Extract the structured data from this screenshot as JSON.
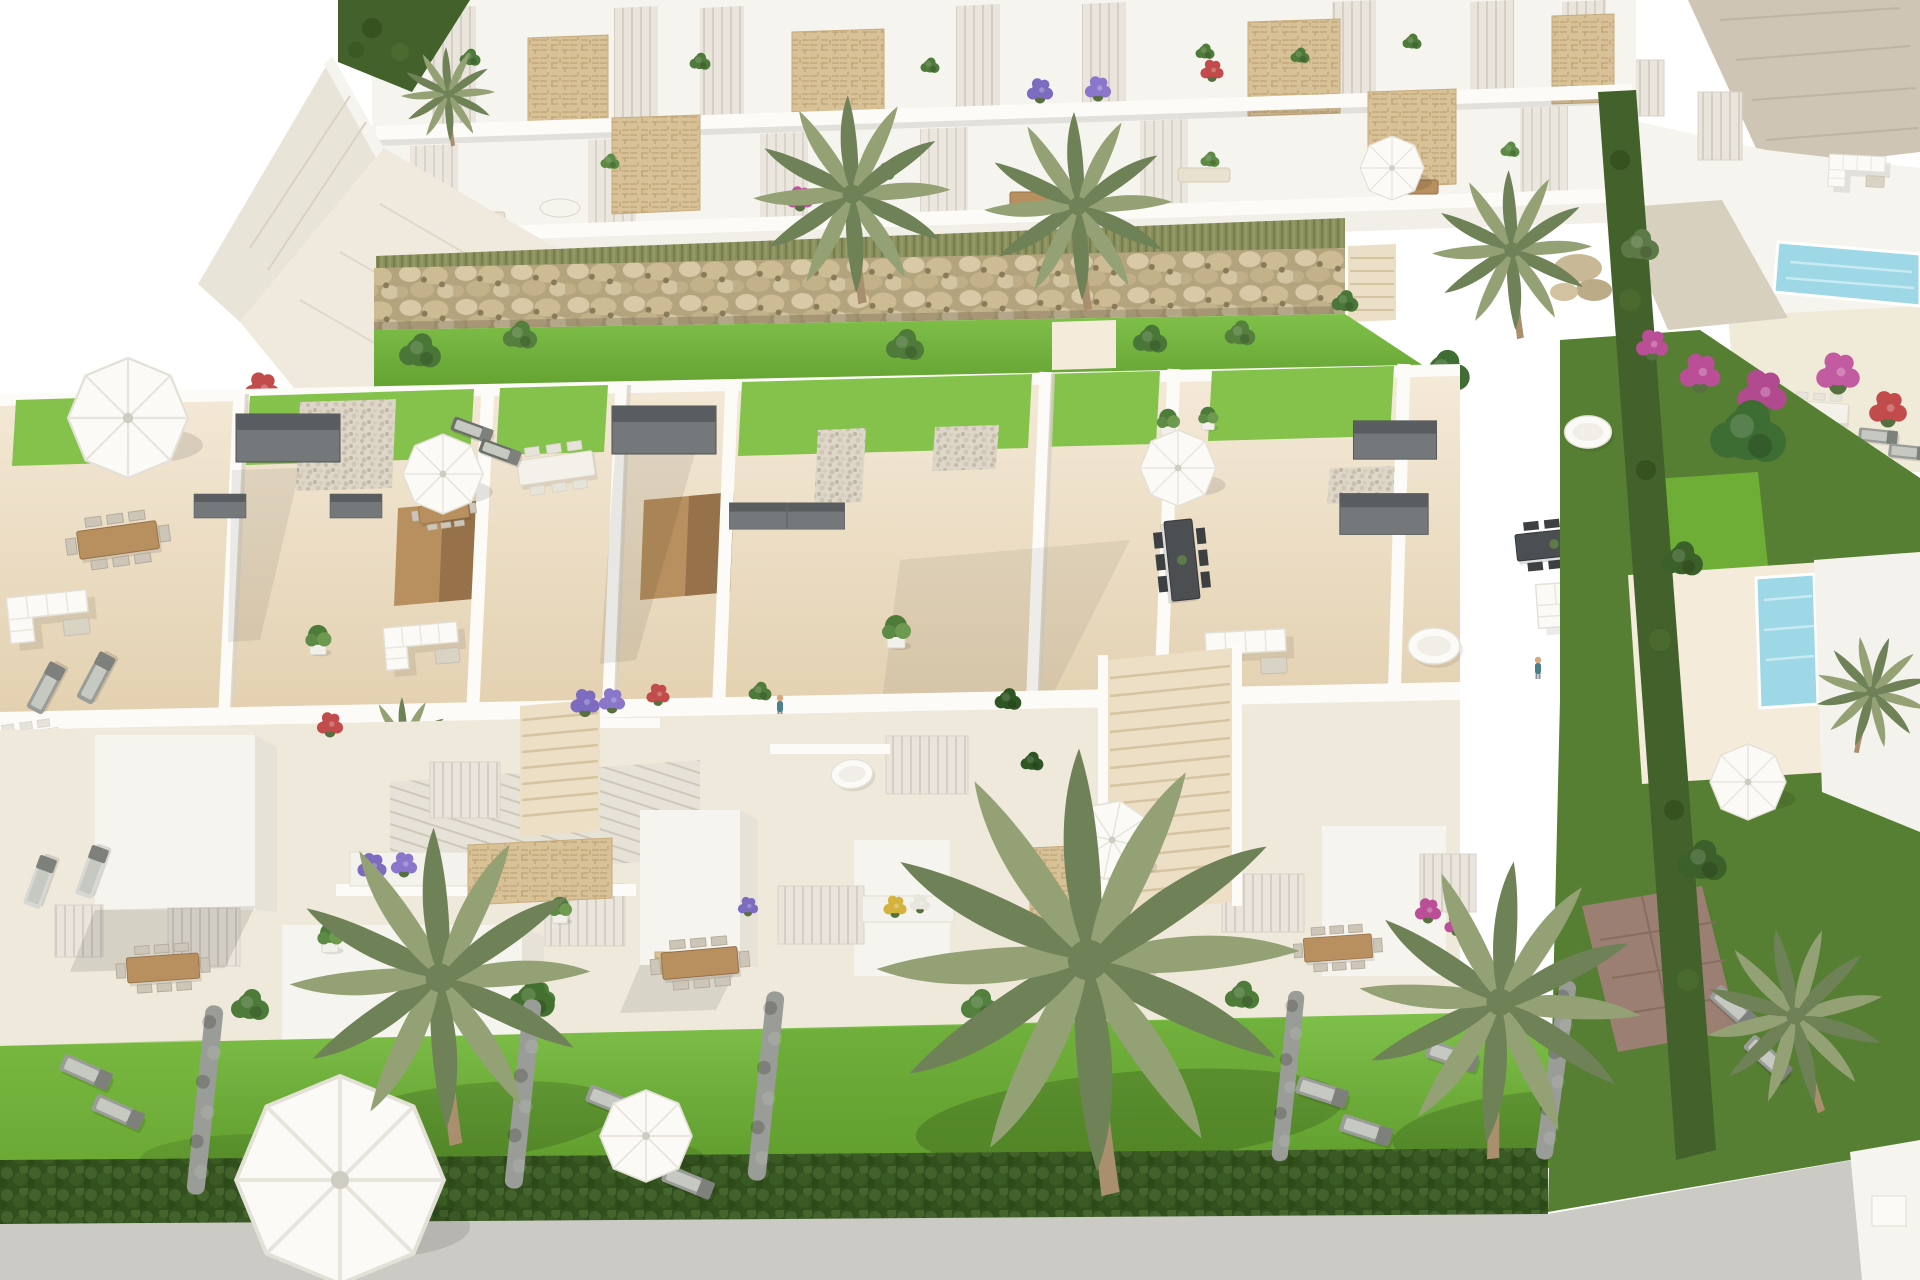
{
  "scene": {
    "type": "3d-architectural-render",
    "subject": "aerial-view-of-modern-white-townhouse-residential-development",
    "description": "Aerial 3D render of a white Mediterranean townhouse development: a two-storey apartment row with planted balconies at top, a boulder gabion wall, a row of rooftop solarium terraces with lawns, pergolas and outdoor furniture, street-level facades with flower planters, front gardens with palm trees, sun loungers, parasols and hedges, a neighbouring villa with pools on the right, and a grey road at the bottom.",
    "visible_text": "",
    "elements": [
      "apartment-block",
      "balcony",
      "stone-clad-panel",
      "gabion-rock-wall",
      "ornamental-grass-strip",
      "rooftop-solarium-terrace",
      "artificial-lawn-patch",
      "pergola",
      "outdoor-kitchen",
      "stair-bulkhead",
      "dining-table",
      "corner-sofa",
      "parasol",
      "sun-lounger",
      "potted-plant",
      "person",
      "townhouse-facade",
      "flower-planter",
      "staircase",
      "garden-lawn",
      "boxwood-hedge",
      "palm-tree",
      "neighbour-villa",
      "swimming-pool",
      "bougainvillea",
      "paver-driveway",
      "road"
    ]
  },
  "palette": {
    "paper": "#ffffff",
    "bldg": "#f6f4ee",
    "bldg_shadow": "#e7e2d8",
    "slab": "#fcfbf7",
    "recess": "#e8e4db",
    "recess_line": "#cfcabf",
    "sand": "#ead9bd",
    "sand_light": "#f4ebda",
    "sand_shadow": "#dcc6a3",
    "wood": "#b8905f",
    "wood_dark": "#96714a",
    "stone": "#d7c094",
    "stone_line": "#b89d6e",
    "rock_bg": "#b2a37d",
    "grass_tall": "#8a8f5e",
    "lawn": "#6fae36",
    "lawn_light": "#84c24b",
    "lawn_dark": "#55922a",
    "hedge": "#42612b",
    "hedge_dark": "#314f1d",
    "bush": "#4e7a3a",
    "palm": "#93a175",
    "palm_dark": "#6e8157",
    "trunk": "#a98f6d",
    "pool": "#9ed7e6",
    "pool_dark": "#6db6d2",
    "road": "#cbcac5",
    "gutter": "#4e443c",
    "pergola": "#74787b",
    "pergola_dark": "#595d60",
    "furn_gray": "#9a9c97",
    "furn_gray_light": "#c6c8c2",
    "white_furn": "#fbfaf7",
    "furn_line": "#e3e0d6",
    "pot_white": "#f2f0ea",
    "paver": "#9b7f72",
    "paver_line": "#876c60",
    "skin": "#d8a77f",
    "shirt": "#4a7f8c"
  },
  "stamps": {
    "top_plants": [
      {
        "t": "bush",
        "x": 470,
        "y": 58,
        "s": 0.55
      },
      {
        "t": "bush",
        "x": 700,
        "y": 62,
        "s": 0.55
      },
      {
        "t": "bush",
        "x": 930,
        "y": 66,
        "s": 0.5
      },
      {
        "t": "bush",
        "x": 1205,
        "y": 52,
        "s": 0.5
      },
      {
        "t": "bush",
        "x": 1300,
        "y": 56,
        "s": 0.5
      },
      {
        "t": "bush",
        "x": 1412,
        "y": 42,
        "s": 0.5
      },
      {
        "t": "bush",
        "x": 610,
        "y": 162,
        "s": 0.5,
        "c": "#5d8a44"
      },
      {
        "t": "bush",
        "x": 884,
        "y": 172,
        "s": 0.55,
        "c": "#5d8a44"
      },
      {
        "t": "bush",
        "x": 1210,
        "y": 160,
        "s": 0.5,
        "c": "#5d8a44"
      },
      {
        "t": "bush",
        "x": 1510,
        "y": 150,
        "s": 0.5,
        "c": "#5d8a44"
      },
      {
        "t": "flower",
        "x": 1040,
        "y": 90,
        "s": 0.9,
        "c": "#7d6bbf"
      },
      {
        "t": "flower",
        "x": 1098,
        "y": 88,
        "s": 0.9,
        "c": "#8a77cc"
      },
      {
        "t": "flower",
        "x": 1212,
        "y": 70,
        "s": 0.8,
        "c": "#c24b4b"
      },
      {
        "t": "flower",
        "x": 800,
        "y": 198,
        "s": 0.9,
        "c": "#c0549c"
      },
      {
        "t": "flower",
        "x": 262,
        "y": 388,
        "s": 1.2,
        "c": "#c24b4b"
      },
      {
        "t": "bush",
        "x": 420,
        "y": 352,
        "s": 1.1,
        "c": "#4a7637"
      },
      {
        "t": "bush",
        "x": 520,
        "y": 336,
        "s": 0.9,
        "c": "#557f3c"
      },
      {
        "t": "bush",
        "x": 905,
        "y": 346,
        "s": 1.0,
        "c": "#4e7a3a"
      },
      {
        "t": "bush",
        "x": 1150,
        "y": 340,
        "s": 0.9,
        "c": "#4a7637"
      },
      {
        "t": "bush",
        "x": 1240,
        "y": 334,
        "s": 0.8,
        "c": "#557f3c"
      },
      {
        "t": "bush",
        "x": 1345,
        "y": 302,
        "s": 0.7,
        "c": "#4a7637"
      },
      {
        "t": "bush",
        "x": 1445,
        "y": 372,
        "s": 1.3,
        "c": "#3f6d33"
      }
    ],
    "palms_top": [
      {
        "x": 852,
        "y": 194,
        "s": 1.05
      },
      {
        "x": 1078,
        "y": 206,
        "s": 1.0
      },
      {
        "x": 1512,
        "y": 250,
        "s": 0.85
      },
      {
        "x": 448,
        "y": 94,
        "s": 0.5
      }
    ],
    "rooftop_items": [
      {
        "t": "pergola",
        "x": 288,
        "y": 438
      },
      {
        "t": "pergola",
        "x": 664,
        "y": 430
      },
      {
        "t": "pergola",
        "x": 758,
        "y": 516,
        "s": 0.55
      },
      {
        "t": "pergola",
        "x": 816,
        "y": 516,
        "s": 0.55
      },
      {
        "t": "pergola",
        "x": 1395,
        "y": 440,
        "s": 0.8
      },
      {
        "t": "pergola",
        "x": 1384,
        "y": 514,
        "s": 0.85
      },
      {
        "t": "pergola",
        "x": 220,
        "y": 506,
        "s": 0.5
      },
      {
        "t": "pergola",
        "x": 356,
        "y": 506,
        "s": 0.5
      },
      {
        "t": "table-brown",
        "x": 118,
        "y": 540,
        "r": -8
      },
      {
        "t": "table-brown",
        "x": 444,
        "y": 512,
        "r": -8,
        "s": 0.62
      },
      {
        "t": "table-white",
        "x": 556,
        "y": 468,
        "r": -8,
        "s": 0.95
      },
      {
        "t": "table-white",
        "x": 28,
        "y": 742,
        "r": -8,
        "s": 0.8
      },
      {
        "t": "table-dark",
        "x": 1182,
        "y": 560,
        "r": 84
      },
      {
        "t": "table-dark",
        "x": 1554,
        "y": 544,
        "r": -6,
        "s": 0.95
      },
      {
        "t": "table-white",
        "x": 1818,
        "y": 412,
        "r": 4,
        "s": 0.75
      },
      {
        "t": "sofa",
        "x": 1262,
        "y": 650,
        "r": -3
      },
      {
        "t": "sofa",
        "x": 1590,
        "y": 600,
        "r": -4,
        "s": 0.95
      },
      {
        "t": "sofa",
        "x": 436,
        "y": 642,
        "r": -5,
        "s": 0.92
      },
      {
        "t": "sofa",
        "x": 64,
        "y": 612,
        "r": -6,
        "c": "#eae2d0"
      },
      {
        "t": "sofa",
        "x": 1868,
        "y": 170,
        "r": 3,
        "s": 0.7
      },
      {
        "t": "pot",
        "x": 896,
        "y": 634
      },
      {
        "t": "pot",
        "x": 318,
        "y": 642,
        "s": 0.9
      },
      {
        "t": "pot",
        "x": 1168,
        "y": 424,
        "s": 0.8
      },
      {
        "t": "pot",
        "x": 1208,
        "y": 420,
        "s": 0.7
      },
      {
        "t": "daybed",
        "x": 1434,
        "y": 646
      },
      {
        "t": "parasol",
        "x": 443,
        "y": 474
      },
      {
        "t": "parasol",
        "x": 1178,
        "y": 468,
        "s": 0.95
      },
      {
        "t": "parasol",
        "x": 1626,
        "y": 574
      },
      {
        "t": "parasol",
        "x": 128,
        "y": 418,
        "s": 1.5
      },
      {
        "t": "parasol",
        "x": 1392,
        "y": 168,
        "s": 0.8
      },
      {
        "t": "lounger",
        "x": 1686,
        "y": 584,
        "r": 30
      },
      {
        "t": "lounger",
        "x": 1712,
        "y": 626,
        "r": 30
      },
      {
        "t": "lounger",
        "x": 1739,
        "y": 668,
        "r": 30
      },
      {
        "t": "lounger",
        "x": 1766,
        "y": 710,
        "r": 30
      },
      {
        "t": "lounger",
        "x": 46,
        "y": 688,
        "r": -62
      },
      {
        "t": "lounger",
        "x": 96,
        "y": 678,
        "r": -62
      },
      {
        "t": "lounger",
        "x": 1878,
        "y": 436,
        "r": 6,
        "s": 0.75
      },
      {
        "t": "lounger",
        "x": 1908,
        "y": 452,
        "r": 6,
        "s": 0.75
      },
      {
        "t": "lounger",
        "x": 472,
        "y": 430,
        "r": 20,
        "s": 0.8,
        "c": "#6d6f6a"
      },
      {
        "t": "lounger",
        "x": 500,
        "y": 452,
        "r": 20,
        "s": 0.8,
        "c": "#6d6f6a"
      },
      {
        "t": "person",
        "x": 780,
        "y": 706
      },
      {
        "t": "person",
        "x": 1538,
        "y": 668
      },
      {
        "t": "palm",
        "x": 404,
        "y": 744,
        "s": 0.5
      }
    ],
    "facade_items": [
      {
        "t": "flower",
        "x": 372,
        "y": 866,
        "c": "#7d6bbf"
      },
      {
        "t": "flower",
        "x": 404,
        "y": 864,
        "s": 0.9,
        "c": "#8a77cc"
      },
      {
        "t": "flower",
        "x": 585,
        "y": 702,
        "c": "#7d6bbf"
      },
      {
        "t": "flower",
        "x": 612,
        "y": 700,
        "s": 0.9,
        "c": "#8a77cc"
      },
      {
        "t": "flower",
        "x": 658,
        "y": 694,
        "s": 0.8,
        "c": "#c24b4b"
      },
      {
        "t": "flower",
        "x": 330,
        "y": 724,
        "s": 0.9,
        "c": "#c24b4b"
      },
      {
        "t": "flower",
        "x": 895,
        "y": 906,
        "s": 0.8,
        "c": "#d4b23e"
      },
      {
        "t": "flower",
        "x": 920,
        "y": 903,
        "s": 0.7,
        "c": "#e8e6dc"
      },
      {
        "t": "flower",
        "x": 748,
        "y": 906,
        "s": 0.7,
        "c": "#7d6bbf"
      },
      {
        "t": "flower",
        "x": 782,
        "y": 1094,
        "s": 0.9,
        "c": "#7d6bbf"
      },
      {
        "t": "flower",
        "x": 1428,
        "y": 910,
        "s": 0.9,
        "c": "#bb4f97"
      },
      {
        "t": "flower",
        "x": 1456,
        "y": 924,
        "s": 0.8,
        "c": "#bb4f97"
      },
      {
        "t": "bush",
        "x": 1008,
        "y": 700,
        "s": 0.7,
        "c": "#2f5523"
      },
      {
        "t": "bush",
        "x": 1032,
        "y": 762,
        "s": 0.6,
        "c": "#2f5523"
      },
      {
        "t": "bush",
        "x": 760,
        "y": 692,
        "s": 0.6,
        "c": "#4e7a3a"
      },
      {
        "t": "bush",
        "x": 620,
        "y": 1120,
        "s": 1.0,
        "c": "#3c6029"
      },
      {
        "t": "bush",
        "x": 540,
        "y": 996,
        "s": 0.8,
        "c": "#4e7a3a"
      },
      {
        "t": "daybed",
        "x": 852,
        "y": 774,
        "s": 0.8,
        "r": -6
      },
      {
        "t": "pot",
        "x": 330,
        "y": 940,
        "s": 0.9
      },
      {
        "t": "pot",
        "x": 560,
        "y": 912,
        "s": 0.8
      }
    ],
    "garden_items": [
      {
        "t": "table-brown",
        "x": 163,
        "y": 968,
        "r": -4,
        "s": 0.9
      },
      {
        "t": "table-brown",
        "x": 700,
        "y": 963,
        "r": -5,
        "s": 0.95
      },
      {
        "t": "table-brown",
        "x": 1115,
        "y": 962,
        "r": -5,
        "s": 0.95
      },
      {
        "t": "table-brown",
        "x": 1338,
        "y": 948,
        "r": -4,
        "s": 0.85
      },
      {
        "t": "parasol",
        "x": 1112,
        "y": 840,
        "r": 12
      },
      {
        "t": "lounger",
        "x": 86,
        "y": 1072,
        "r": 24
      },
      {
        "t": "lounger",
        "x": 118,
        "y": 1112,
        "r": 24
      },
      {
        "t": "lounger",
        "x": 40,
        "y": 882,
        "r": -70,
        "c": "#d8d8d2"
      },
      {
        "t": "lounger",
        "x": 92,
        "y": 872,
        "r": -70,
        "c": "#d8d8d2"
      },
      {
        "t": "lounger",
        "x": 612,
        "y": 1102,
        "r": 22
      },
      {
        "t": "lounger",
        "x": 650,
        "y": 1142,
        "r": 22
      },
      {
        "t": "lounger",
        "x": 688,
        "y": 1182,
        "r": 22
      },
      {
        "t": "lounger",
        "x": 1322,
        "y": 1092,
        "r": 18
      },
      {
        "t": "lounger",
        "x": 1366,
        "y": 1130,
        "r": 18
      },
      {
        "t": "lounger",
        "x": 1452,
        "y": 1056,
        "r": 18
      },
      {
        "t": "bush",
        "x": 250,
        "y": 1006,
        "c": "#4e7a3a"
      },
      {
        "t": "bush",
        "x": 532,
        "y": 1000,
        "s": 1.2,
        "c": "#44702f"
      },
      {
        "t": "bush",
        "x": 980,
        "y": 1006,
        "c": "#52803d"
      },
      {
        "t": "bush",
        "x": 1242,
        "y": 996,
        "s": 0.9,
        "c": "#4e7a3a"
      },
      {
        "t": "hedgecol",
        "x": 205,
        "y": 1100,
        "r": 6
      },
      {
        "t": "hedgecol",
        "x": 523,
        "y": 1094,
        "r": 6
      },
      {
        "t": "hedgecol",
        "x": 766,
        "y": 1086,
        "r": 6
      },
      {
        "t": "hedgecol",
        "x": 1288,
        "y": 1076,
        "r": 6,
        "s": 0.9
      },
      {
        "t": "hedgecol",
        "x": 1556,
        "y": 1070,
        "r": 8,
        "s": 0.95
      },
      {
        "t": "parasol",
        "x": 646,
        "y": 1136,
        "s": 1.15
      },
      {
        "t": "parasol",
        "x": 340,
        "y": 1180,
        "s": 2.6
      },
      {
        "t": "flower",
        "x": 1700,
        "y": 372,
        "s": 1.4,
        "c": "#bb4f97"
      },
      {
        "t": "flower",
        "x": 1762,
        "y": 392,
        "s": 1.7,
        "c": "#b14a8e"
      },
      {
        "t": "flower",
        "x": 1838,
        "y": 372,
        "s": 1.5,
        "c": "#c25ba0"
      },
      {
        "t": "flower",
        "x": 1888,
        "y": 408,
        "s": 1.3,
        "c": "#c24b4b"
      },
      {
        "t": "flower",
        "x": 1652,
        "y": 344,
        "s": 1.1,
        "c": "#bb4f97"
      },
      {
        "t": "bush",
        "x": 1748,
        "y": 434,
        "s": 2.0,
        "c": "#3e6d33"
      },
      {
        "t": "bush",
        "x": 1682,
        "y": 560,
        "s": 1.1,
        "c": "#3c6029"
      },
      {
        "t": "bush",
        "x": 1702,
        "y": 862,
        "s": 1.3,
        "c": "#3c6029"
      },
      {
        "t": "bush",
        "x": 1640,
        "y": 246,
        "s": 1.0,
        "c": "#5d7a46"
      },
      {
        "t": "daybed",
        "x": 1588,
        "y": 432,
        "s": 0.9
      },
      {
        "t": "lounger",
        "x": 1734,
        "y": 1008,
        "r": 42
      },
      {
        "t": "lounger",
        "x": 1768,
        "y": 1058,
        "r": 42
      },
      {
        "t": "parasol",
        "x": 1748,
        "y": 782,
        "s": 0.95
      },
      {
        "t": "palm",
        "x": 440,
        "y": 978,
        "s": 1.6
      },
      {
        "t": "palm",
        "x": 1088,
        "y": 960,
        "s": 2.25
      },
      {
        "t": "palm",
        "x": 1500,
        "y": 1002,
        "s": 1.5,
        "r": 8
      },
      {
        "t": "palm",
        "x": 1795,
        "y": 1016,
        "s": 0.95,
        "r": -10
      },
      {
        "t": "palm",
        "x": 1872,
        "y": 692,
        "s": 0.6,
        "r": 20
      }
    ]
  }
}
